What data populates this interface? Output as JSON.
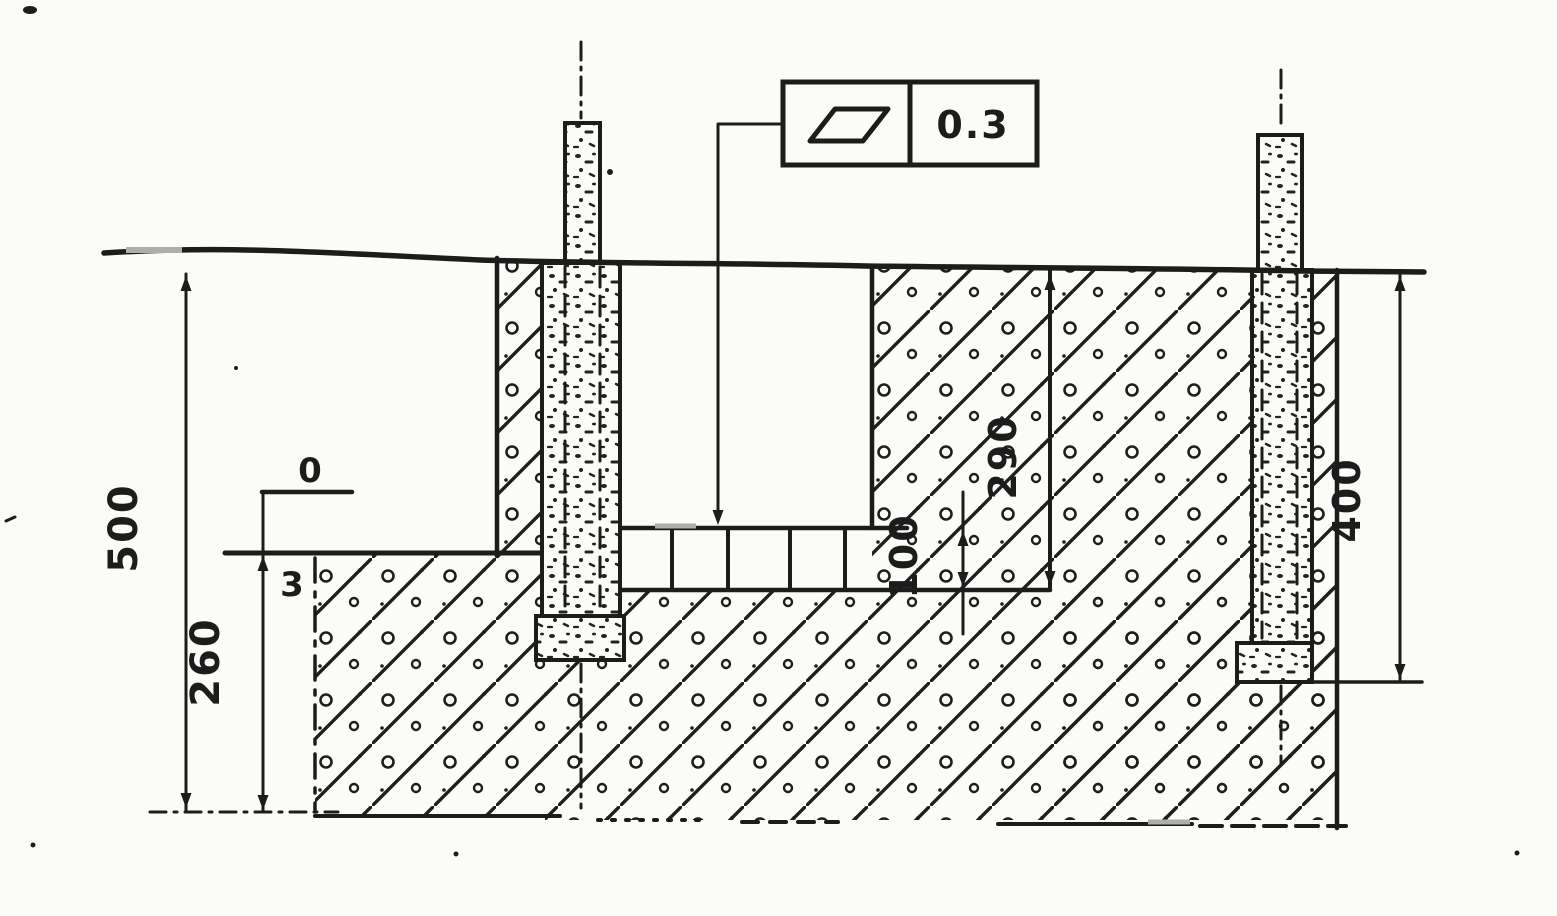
{
  "drawing_type": "foundation-post-installation-section",
  "colors": {
    "ink": "#1c1c1c",
    "paper": "#fbfbf8"
  },
  "tolerance_frame": {
    "symbol": "flatness",
    "value": "0.3"
  },
  "dimensions": {
    "total_depth": "500",
    "lower_depth": "260",
    "trench_depth": "290",
    "brick_course_height": "100",
    "post_embedment": "400"
  },
  "level_marks": {
    "upper": "0",
    "lower": "3"
  }
}
